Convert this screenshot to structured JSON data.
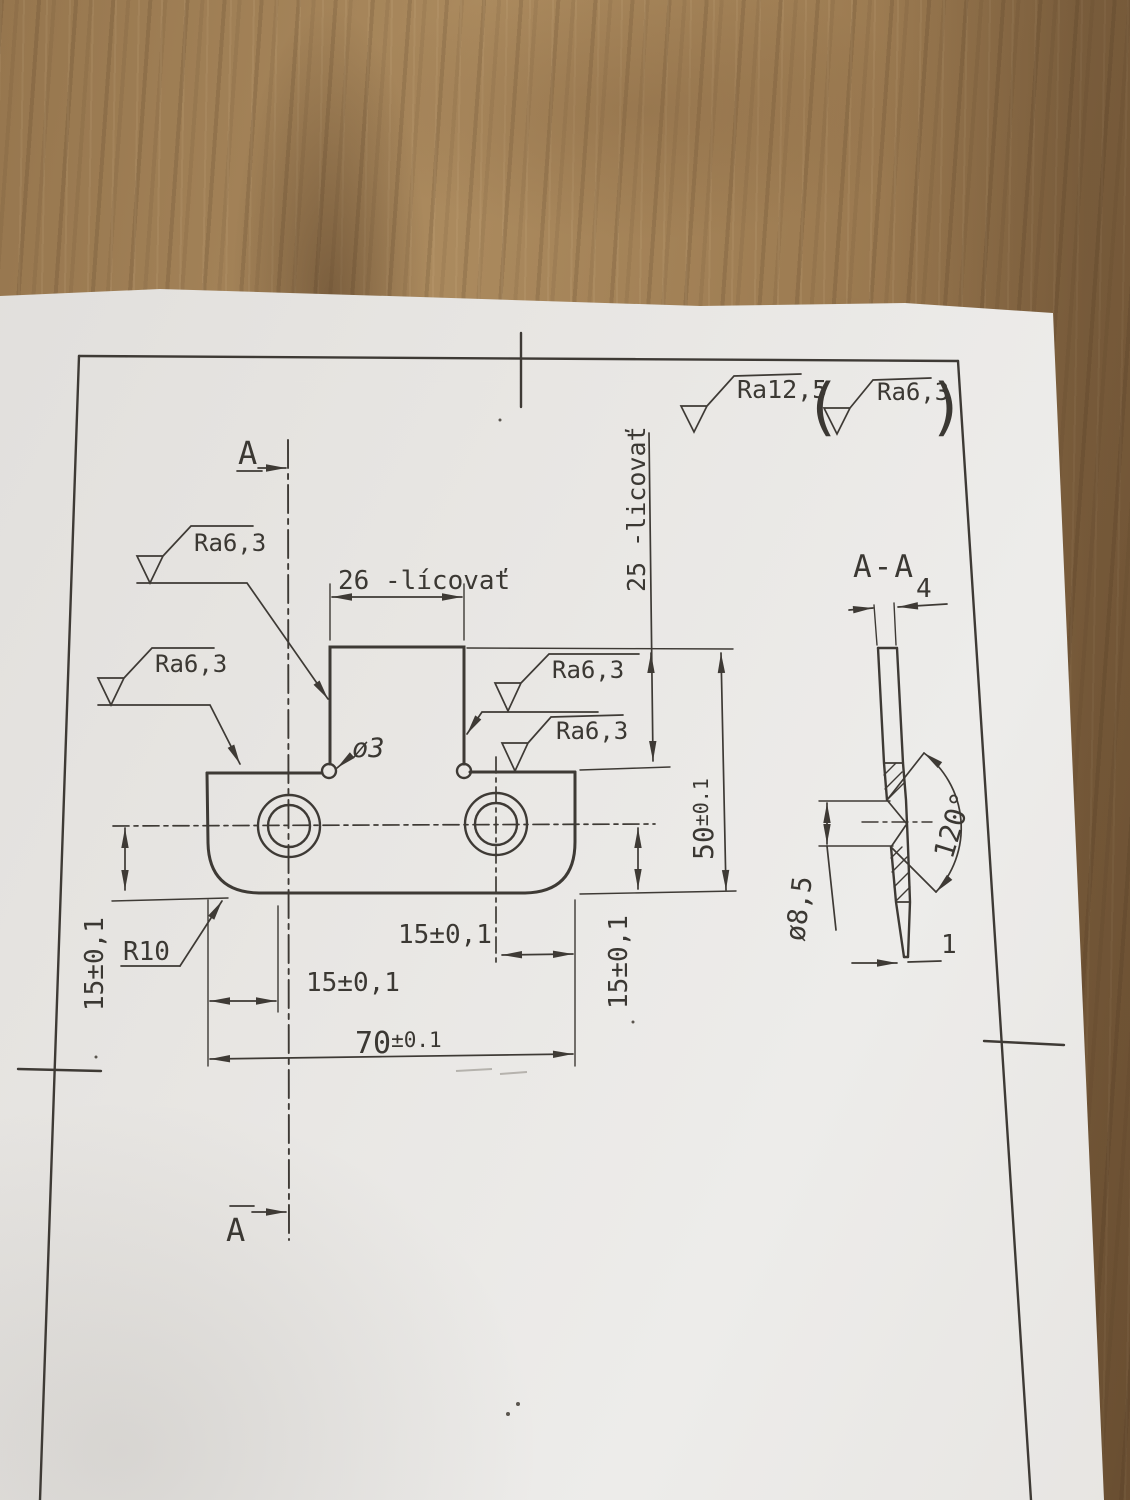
{
  "general_roughness": {
    "primary": "Ra12,5",
    "paren_open": "(",
    "secondary": "Ra6,3",
    "paren_close": ")"
  },
  "main_view": {
    "cut_label_top": "A",
    "cut_label_bottom": "A",
    "dim_tab_width": "26 -lícovať",
    "dim_upper_height": "25 -licovať",
    "dim_total_height": {
      "value": "50",
      "tol": "±0.1"
    },
    "dim_total_width": {
      "value": "70",
      "tol": "±0.1"
    },
    "dim_hole_from_left": "15±0,1",
    "dim_hole_from_right": "15±0,1",
    "dim_hole_height_left": "15±0,1",
    "dim_hole_height_right": "15±0,1",
    "corner_radius": "R10",
    "relief_hole_dia": "ø3",
    "roughness_notch_left": "Ra6,3",
    "roughness_edge_left": "Ra6,3",
    "roughness_notch_right": "Ra6,3",
    "roughness_top_edge": "Ra6,3"
  },
  "section_view": {
    "title": "A-A",
    "dim_thickness": "4",
    "dim_countersink_dia": "ø8,5",
    "dim_countersink_angle": "120°",
    "dim_edge_land": "1"
  }
}
